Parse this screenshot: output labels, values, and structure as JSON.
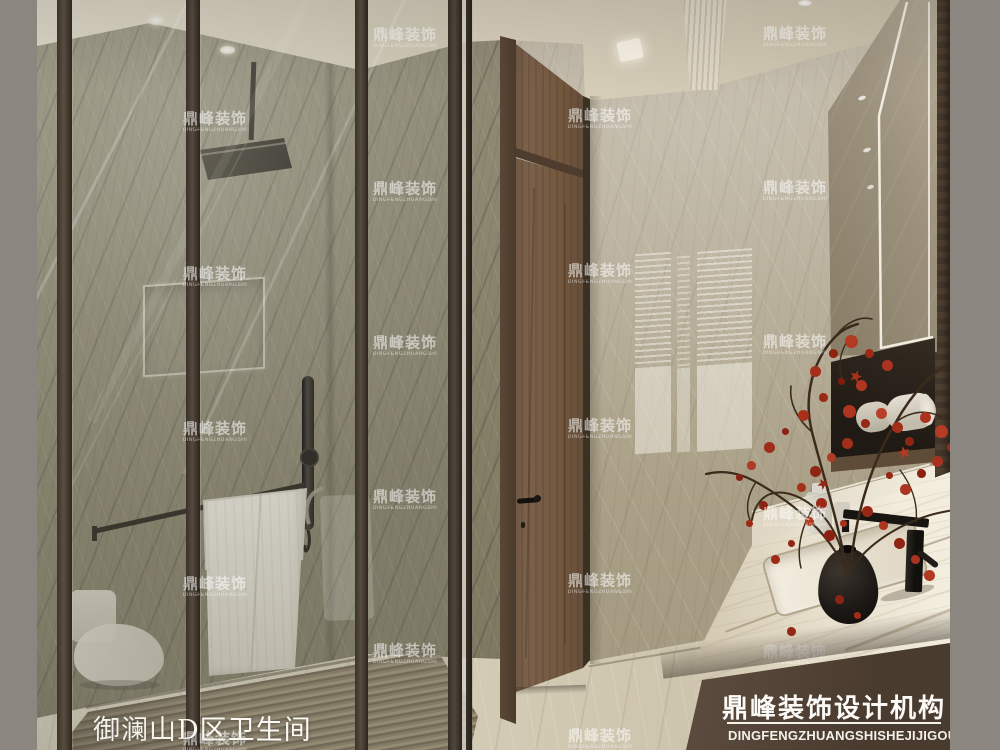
{
  "title": {
    "text": "御澜山D区卫生间"
  },
  "banner": {
    "name_cn": "鼎峰装饰设计机构",
    "name_en": "DINGFENGZHUANGSHISHEJIJIGOU"
  },
  "watermark": {
    "text_cn": "鼎峰装饰",
    "text_en": "DINGFENGZHUANGSHI",
    "positions": [
      {
        "x": 215,
        "y": 122
      },
      {
        "x": 215,
        "y": 277
      },
      {
        "x": 215,
        "y": 432
      },
      {
        "x": 215,
        "y": 587
      },
      {
        "x": 215,
        "y": 742
      },
      {
        "x": 405,
        "y": 38
      },
      {
        "x": 405,
        "y": 192
      },
      {
        "x": 405,
        "y": 346
      },
      {
        "x": 405,
        "y": 500
      },
      {
        "x": 405,
        "y": 654
      },
      {
        "x": 600,
        "y": 119
      },
      {
        "x": 600,
        "y": 274
      },
      {
        "x": 600,
        "y": 429
      },
      {
        "x": 600,
        "y": 584
      },
      {
        "x": 600,
        "y": 739
      },
      {
        "x": 795,
        "y": 37
      },
      {
        "x": 795,
        "y": 191
      },
      {
        "x": 795,
        "y": 345
      },
      {
        "x": 795,
        "y": 517
      },
      {
        "x": 795,
        "y": 655
      }
    ]
  },
  "palette": {
    "margin_gray": "#8c8680",
    "ceiling_cream": "#d9d1c0",
    "wall_marble": "#b0a692",
    "shower_marble": "#8b8572",
    "floor_marble": "#d2c9b4",
    "teak_mat": "#91836b",
    "door_wood": "#6f5743",
    "dark_wood_panel": "#48392c",
    "counter_marble": "#ece5d4",
    "banner_bg": "#54453a",
    "leaf_red": "#a22e1a",
    "fixture_black": "#1b1815",
    "towel_white": "#eae6dc",
    "led_white": "#f6f2e6"
  }
}
